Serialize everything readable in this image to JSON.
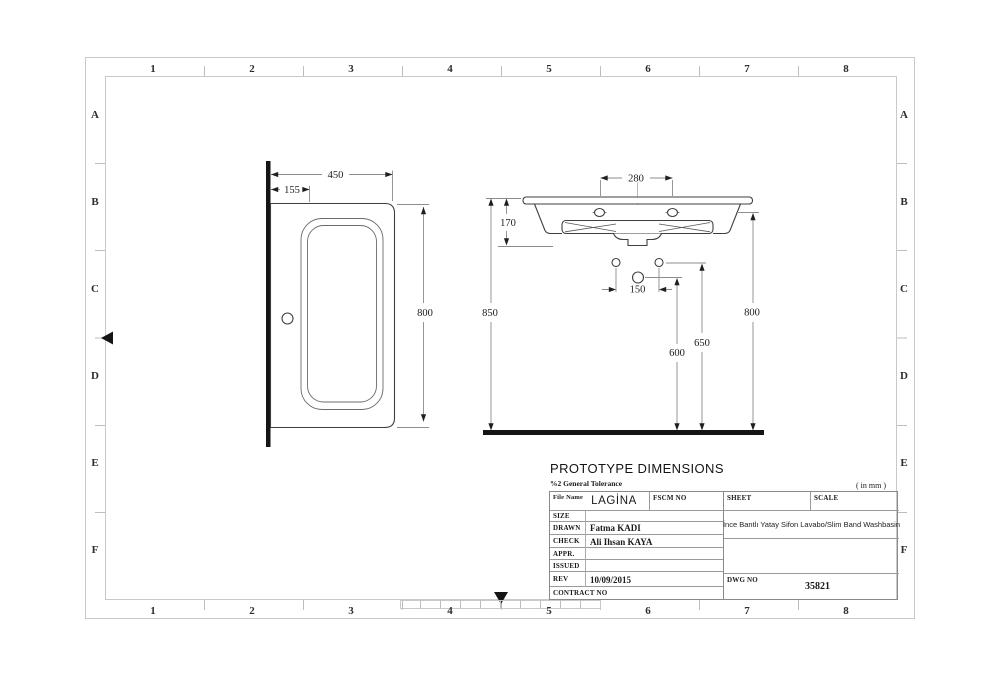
{
  "sheet": {
    "grid_columns": [
      "1",
      "2",
      "3",
      "4",
      "5",
      "6",
      "7",
      "8"
    ],
    "grid_rows": [
      "A",
      "B",
      "C",
      "D",
      "E",
      "F"
    ]
  },
  "drawing": {
    "top_view": {
      "width": "450",
      "band_offset": "155",
      "depth": "800"
    },
    "front_view": {
      "tap_hole_span": "280",
      "body_depth": "170",
      "overall_height": "850",
      "fixing_hole_span": "150",
      "drain_height": "600",
      "fixing_hole_height": "650",
      "rim_height": "800"
    }
  },
  "title_block": {
    "heading": "PROTOTYPE DIMENSIONS",
    "tolerance": "%2 General Tolerance",
    "units": "( in mm )",
    "file_name_label": "File Name",
    "file_name": "LAGİNA",
    "fscm_label": "FSCM NO",
    "sheet_label": "SHEET",
    "scale_label": "SCALE",
    "size_label": "SIZE",
    "drawn_label": "DRAWN",
    "drawn_value": "Fatma KADI",
    "check_label": "CHECK",
    "check_value": "Ali Ihsan KAYA",
    "appr_label": "APPR.",
    "issued_label": "ISSUED",
    "rev_label": "REV",
    "rev_value": "10/09/2015",
    "contract_label": "CONTRACT NO",
    "description": "İnce Bantlı Yatay Sifon Lavabo/Slim Band Washbasin",
    "dwg_label": "DWG NO",
    "dwg_value": "35821"
  }
}
